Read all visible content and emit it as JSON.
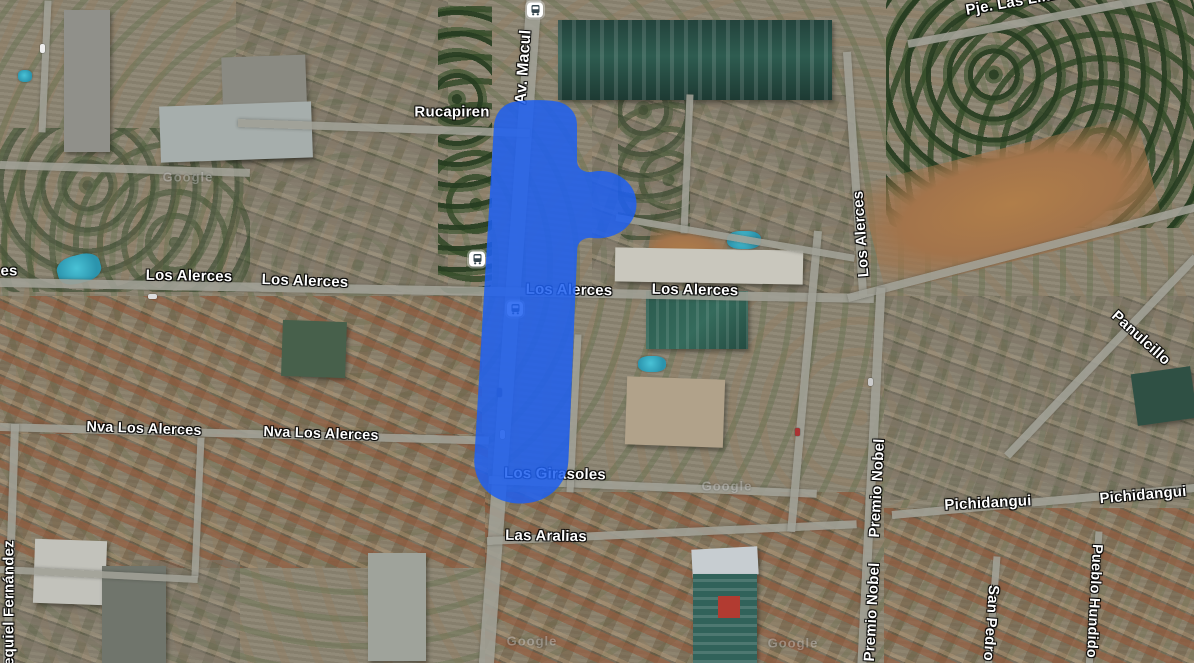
{
  "map": {
    "view_type": "satellite",
    "labels": {
      "rucapiren": "Rucapiren",
      "av_macul": "Av. Macul",
      "pje_las_lilas": "Pje. Las Lilas",
      "fragment_es": "es",
      "los_alerces": "Los Alerces",
      "nva_los_alerces": "Nva Los Alerces",
      "los_girasoles": "Los Girasoles",
      "las_aralias": "Las Aralias",
      "panulcillo": "Panulcillo",
      "premio_nobel": "Premio Nobel",
      "pichidangui": "Pichidangui",
      "san_pedro": "San Pedro",
      "pueblo_hundido": "Pueblo Hundido",
      "ezequiel_fernandez": "Ezequiel Fernández"
    },
    "watermark": "Google",
    "icons": {
      "transit_stop": "bus-icon"
    },
    "overlay": {
      "description": "highlighted area over Av. Macul",
      "color": "#1e5ff0",
      "opacity": "0.86",
      "path": "M510 103 C519 99.5 553 99 562 103 C571.5 107 577 115 577 125 L577 161 C577.5 168.5 583.5 172.5 591 172 C613.5 167 635.5 181 636.5 203 C637 225.5 615.5 240.5 592.5 238 C584 237 578 241.5 577.3 248.5 L568.5 459 C567.5 485.5 547.5 503.5 521 503.5 C494.5 503.5 474.5 487 474.2 460.5 L493.8 128 C494.3 115.5 500.5 106.5 510 103 Z"
    },
    "colors": {
      "street": "#a0a096",
      "label_text": "#ffffff",
      "pool_water": "#2b94ad"
    }
  }
}
